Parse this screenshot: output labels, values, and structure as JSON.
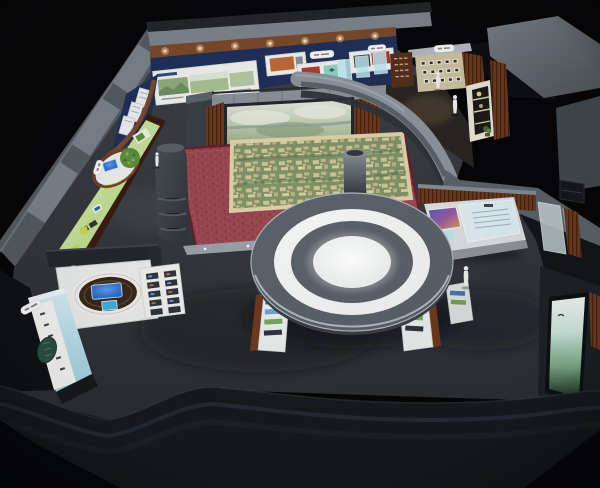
{
  "scene": {
    "type": "3d-exhibition-hall-render",
    "view": "bird-eye-perspective"
  },
  "counts": {
    "human_figures": 4,
    "display_boards": 4,
    "info_signs": 3,
    "round_table_rings": 2
  },
  "colors": {
    "background": "#060608",
    "floor_top": "#3c4046",
    "floor_bottom": "#2b2e34",
    "outer_wall": "#565b62",
    "wall_cap": "#7b828b",
    "bottom_wall": "#171a20",
    "navy_wall": "#20305a",
    "wood_trim": "#7c4a2c",
    "wood_slat": "#6b3a22",
    "tile_wall": "#8b9199",
    "board_white": "#f1f2ef",
    "carpet": "#9a4750",
    "carpet_border": "#5f242c",
    "sand_base": "#7e9268",
    "sand_frame": "#dcd0a8",
    "aerial_top": "#e3e8dd",
    "aerial_bottom": "#8ea37d",
    "green_wall_light": "#e2f2bd",
    "green_wall_dark": "#a9cf70",
    "cyan_kiosk": "#9fd0e2",
    "screen_blue": "#1b55b8",
    "table_grey": "#5a6169",
    "table_white": "#f2f4f4",
    "beige_wall": "#cdc3a3",
    "cabinet": "#eae5d8",
    "curved_wall": "#8d939c",
    "flat_top": "#5d626a",
    "console_glass": "#dff0f4",
    "bright_top": "#f4f8f6",
    "bright_bottom": "#1c3424",
    "figure": "#eef0f2"
  }
}
